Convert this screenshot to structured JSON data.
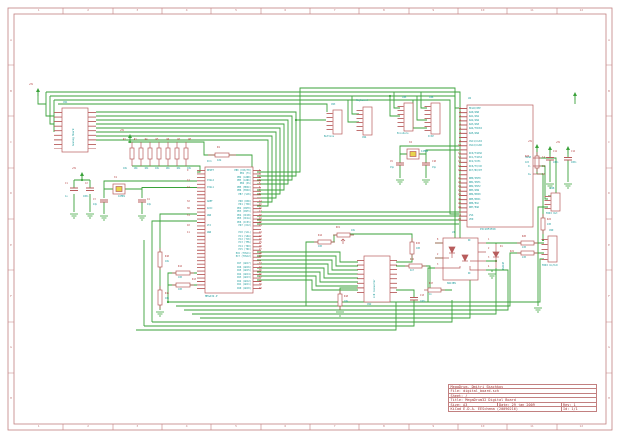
{
  "sheet": {
    "width": 620,
    "height": 438
  },
  "colors": {
    "background": "#ffffff",
    "frame": "#c28080",
    "wire_green": "#3aa23a",
    "component_red": "#b85c5c",
    "ref_text_red": "#b03434",
    "value_text_cyan": "#1a9a9a",
    "crystal_fill_yellow": "#e8d44c",
    "title_text": "#9c2f2f"
  },
  "frame": {
    "zone_columns": [
      "1",
      "2",
      "3",
      "4",
      "5",
      "6",
      "7",
      "8",
      "9",
      "10",
      "11",
      "12"
    ],
    "zone_rows": [
      "A",
      "B",
      "C",
      "D",
      "E",
      "F",
      "G",
      "H"
    ]
  },
  "title_block": {
    "comment": "MegaDrum, Dmitri Skachkov",
    "file": "File: digital_board.sch",
    "sheet": "Sheet: /",
    "title": "Title: MegaDrum32 Digital Board",
    "size": "Size: A3",
    "date": "Date: 29 jan 2009",
    "rev": "Rev: 1",
    "tool": "KiCad E.D.A.  EESchema (20090216)",
    "id": "Id: 1/1"
  },
  "power": {
    "plus5v": "+5V"
  },
  "components": {
    "cn1": {
      "ref": "CN1",
      "value": "Analog Board"
    },
    "res_row": {
      "refs": [
        "R2",
        "R3",
        "R4",
        "R5",
        "R6",
        "R7",
        "R8"
      ],
      "values": [
        "10k",
        "10k",
        "10k",
        "10k",
        "10k",
        "10k",
        "10k"
      ]
    },
    "r1": {
      "ref": "R1",
      "value": "10k"
    },
    "x1": {
      "ref": "X1",
      "value": "16MHz"
    },
    "c1": {
      "ref": "C1",
      "value": "1u"
    },
    "c2": {
      "ref": "C2",
      "value": "100n"
    },
    "c3": {
      "ref": "C3",
      "value": "22p"
    },
    "c4": {
      "ref": "C4",
      "value": "22p"
    },
    "r10": {
      "ref": "R10",
      "value": "10k"
    },
    "r11": {
      "ref": "R11",
      "value": "10k"
    },
    "r12": {
      "ref": "R12",
      "value": "100"
    },
    "r13": {
      "ref": "R13",
      "value": "100"
    },
    "ic1": {
      "ref": "IC1",
      "value": "MEGA32-P",
      "pin_names_left": [
        "RESET",
        "",
        "",
        "XTAL2",
        "",
        "XTAL1",
        "",
        "",
        "",
        "AREF",
        "",
        "AVCC",
        "",
        "GND",
        "",
        "",
        "VCC",
        "",
        "GND",
        "",
        "",
        "",
        "",
        "",
        "",
        "",
        "",
        "",
        "",
        "",
        "",
        "",
        "",
        "",
        ""
      ],
      "pin_numbers_left": [
        "9",
        "",
        "",
        "12",
        "",
        "13",
        "",
        "",
        "",
        "32",
        "",
        "30",
        "",
        "31",
        "",
        "",
        "10",
        "",
        "11",
        "",
        "",
        "",
        "",
        "",
        "",
        "",
        "",
        "",
        "",
        "",
        "",
        "",
        "",
        "",
        ""
      ],
      "pin_names_right": [
        "PB0 (XCK/T0)",
        "PB1 (T1)",
        "PB2 (AIN0)",
        "PB3 (AIN1)",
        "PB4 (SS)",
        "PB5 (MOSI)",
        "PB6 (MISO)",
        "PB7 (SCK)",
        "",
        "PD0 (RXD)",
        "PD1 (TXD)",
        "PD2 (INT0)",
        "PD3 (INT1)",
        "PD4 (OC1B)",
        "PD5 (OC1A)",
        "PD6 (ICP1)",
        "PD7 (OC2)",
        "",
        "PC0 (SCL)",
        "PC1 (SDA)",
        "PC2 (TCK)",
        "PC3 (TMS)",
        "PC4 (TDO)",
        "PC5 (TDI)",
        "PC6 (TOSC1)",
        "PC7 (TOSC2)",
        "",
        "PA7 (ADC7)",
        "PA6 (ADC6)",
        "PA5 (ADC5)",
        "PA4 (ADC4)",
        "PA3 (ADC3)",
        "PA2 (ADC2)",
        "PA1 (ADC1)",
        "PA0 (ADC0)"
      ],
      "pin_numbers_right": [
        "1",
        "2",
        "3",
        "4",
        "5",
        "6",
        "7",
        "8",
        "",
        "14",
        "15",
        "16",
        "17",
        "18",
        "19",
        "20",
        "21",
        "",
        "22",
        "23",
        "24",
        "25",
        "26",
        "27",
        "28",
        "29",
        "",
        "33",
        "34",
        "35",
        "36",
        "37",
        "38",
        "39",
        "40"
      ]
    },
    "cn3": {
      "ref": "CN3",
      "value": "Buttons"
    },
    "cn4": {
      "ref": "CN4",
      "value": "Keyboard"
    },
    "cn5": {
      "ref": "CN5",
      "value": "Encoders"
    },
    "cn6": {
      "ref": "CN6",
      "value": "ICSP"
    },
    "x2": {
      "ref": "X2",
      "value": "12MHz"
    },
    "c9": {
      "ref": "C9",
      "value": "15p"
    },
    "c10": {
      "ref": "C10",
      "value": "15p"
    },
    "u2": {
      "ref": "U2",
      "value": "PIC18F2550",
      "pin_names_left": [
        "MCLR/VPP",
        "RA0/AN0",
        "RA1/AN1",
        "RA2/AN2",
        "RA3/AN3",
        "RA4/T0CKI",
        "RA5/AN4",
        "",
        "OSC1/CLKI",
        "OSC2/CLKO",
        "",
        "RC0/T1OSO",
        "RC1/T1OSI",
        "RC2/CCP1",
        "RC6/TX/CK",
        "RC7/RX/DT",
        "",
        "RB0/INT0",
        "RB1/INT1",
        "RB2/INT2",
        "RB3/AN9",
        "RB4/KBI0",
        "RB5/KBI1",
        "RB6/PGC",
        "RB7/PGD",
        "",
        "VSS",
        "VDD"
      ],
      "pin_numbers_left": [
        "1",
        "2",
        "3",
        "4",
        "5",
        "6",
        "7",
        "",
        "9",
        "10",
        "",
        "11",
        "12",
        "13",
        "17",
        "18",
        "",
        "21",
        "22",
        "23",
        "24",
        "25",
        "26",
        "27",
        "28",
        "",
        "8",
        "20"
      ],
      "pin_names_right": [
        "",
        "",
        "",
        "",
        "",
        "",
        "",
        "",
        "",
        "",
        "",
        "",
        "VUSB",
        "",
        "D-",
        "",
        "D+",
        "",
        "",
        "",
        "",
        "",
        "",
        "",
        "",
        "",
        "",
        ""
      ],
      "pin_numbers_right": [
        "",
        "",
        "",
        "",
        "",
        "",
        "",
        "",
        "",
        "",
        "",
        "",
        "14",
        "",
        "15",
        "",
        "16",
        "",
        "",
        "",
        "",
        "",
        "",
        "",
        "",
        "",
        "",
        ""
      ]
    },
    "r23": {
      "ref": "R23",
      "value": "1k5"
    },
    "u1": {
      "ref": "U1",
      "value": "6N138N",
      "nc_top": "NC",
      "nc_bottom": "NC",
      "pin_numbers_left": [
        "8",
        "2",
        "3"
      ],
      "pin_numbers_right": [
        "1",
        "2",
        "3",
        "4"
      ]
    },
    "d1": {
      "ref": "D1",
      "value": "1N4148"
    },
    "cn2": {
      "ref": "CN2",
      "value": "LCD Connector"
    },
    "rv1": {
      "ref": "RV1",
      "value": "10k"
    },
    "r14": {
      "ref": "R14",
      "value": "100"
    },
    "r15": {
      "ref": "R15",
      "value": "100"
    },
    "r16": {
      "ref": "R16",
      "value": "4k7"
    },
    "r17": {
      "ref": "R17",
      "value": "1k"
    },
    "r18": {
      "ref": "R18",
      "value": "10k"
    },
    "c13": {
      "ref": "C13",
      "value": "100n"
    },
    "cn8": {
      "ref": "CN8",
      "value": "MIDI Out"
    },
    "cn9": {
      "ref": "CN9",
      "value": "MIDI In/Out"
    },
    "r20": {
      "ref": "R20",
      "value": "220"
    },
    "r21": {
      "ref": "R21",
      "value": "220"
    },
    "r22": {
      "ref": "R22",
      "value": "220"
    },
    "c11": {
      "ref": "C11",
      "value": "100n"
    },
    "c12": {
      "ref": "C12",
      "value": "100n"
    }
  }
}
